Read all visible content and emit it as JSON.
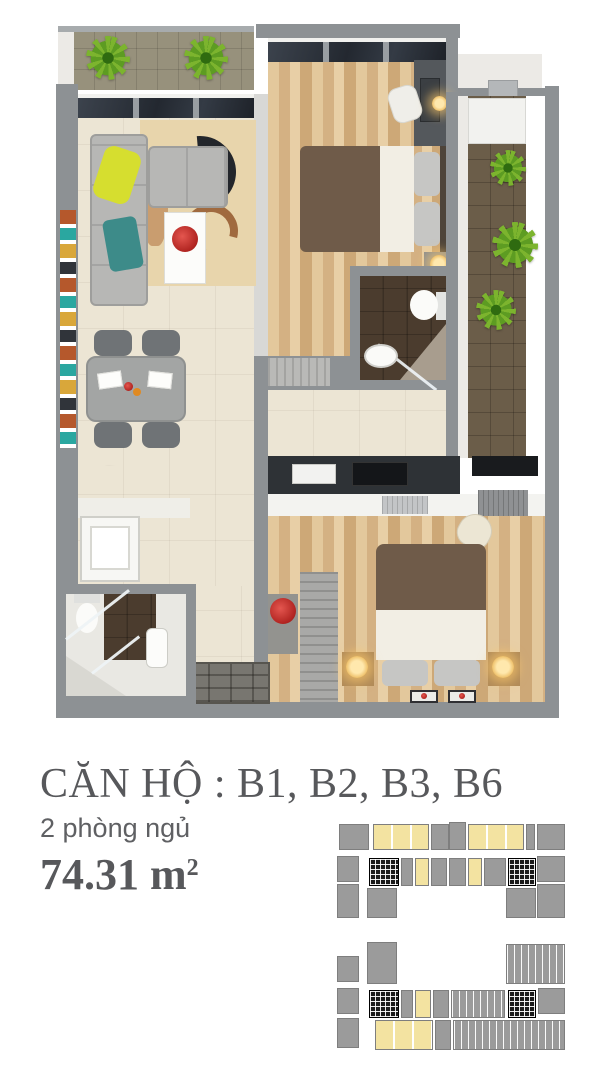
{
  "caption": {
    "title": "CĂN HỘ : B1, B2, B3, B6",
    "subtitle": "2 phòng ngủ",
    "area_value": "74.31 m",
    "area_superscript": "2"
  },
  "keyplan": {
    "diagram_count": 2
  },
  "colors": {
    "wall": "#8d9194",
    "wall_light": "#d8d8d6",
    "floor_beige": "#ece5d4",
    "wood_light": "#e3c89c",
    "wood_dark": "#cda877",
    "balcony_tile": "#97917c",
    "balcony_dark": "#6b5d49",
    "bath_tile_dark": "#4b3c2e",
    "counter_dark": "#2e3236",
    "sofa_gray": "#b7b7b5",
    "accent_yellow": "#d6de2f",
    "bed_brown": "#6f5b49",
    "sheet_white": "#f2eee4",
    "plant_green": "#7cb42e",
    "flower_red": "#b02420",
    "text_gray": "#57585b",
    "keyplan_gray": "#9b9b9b",
    "keyplan_yellow": "#f3e3a1",
    "keyplan_core": "#1a1a1a"
  }
}
